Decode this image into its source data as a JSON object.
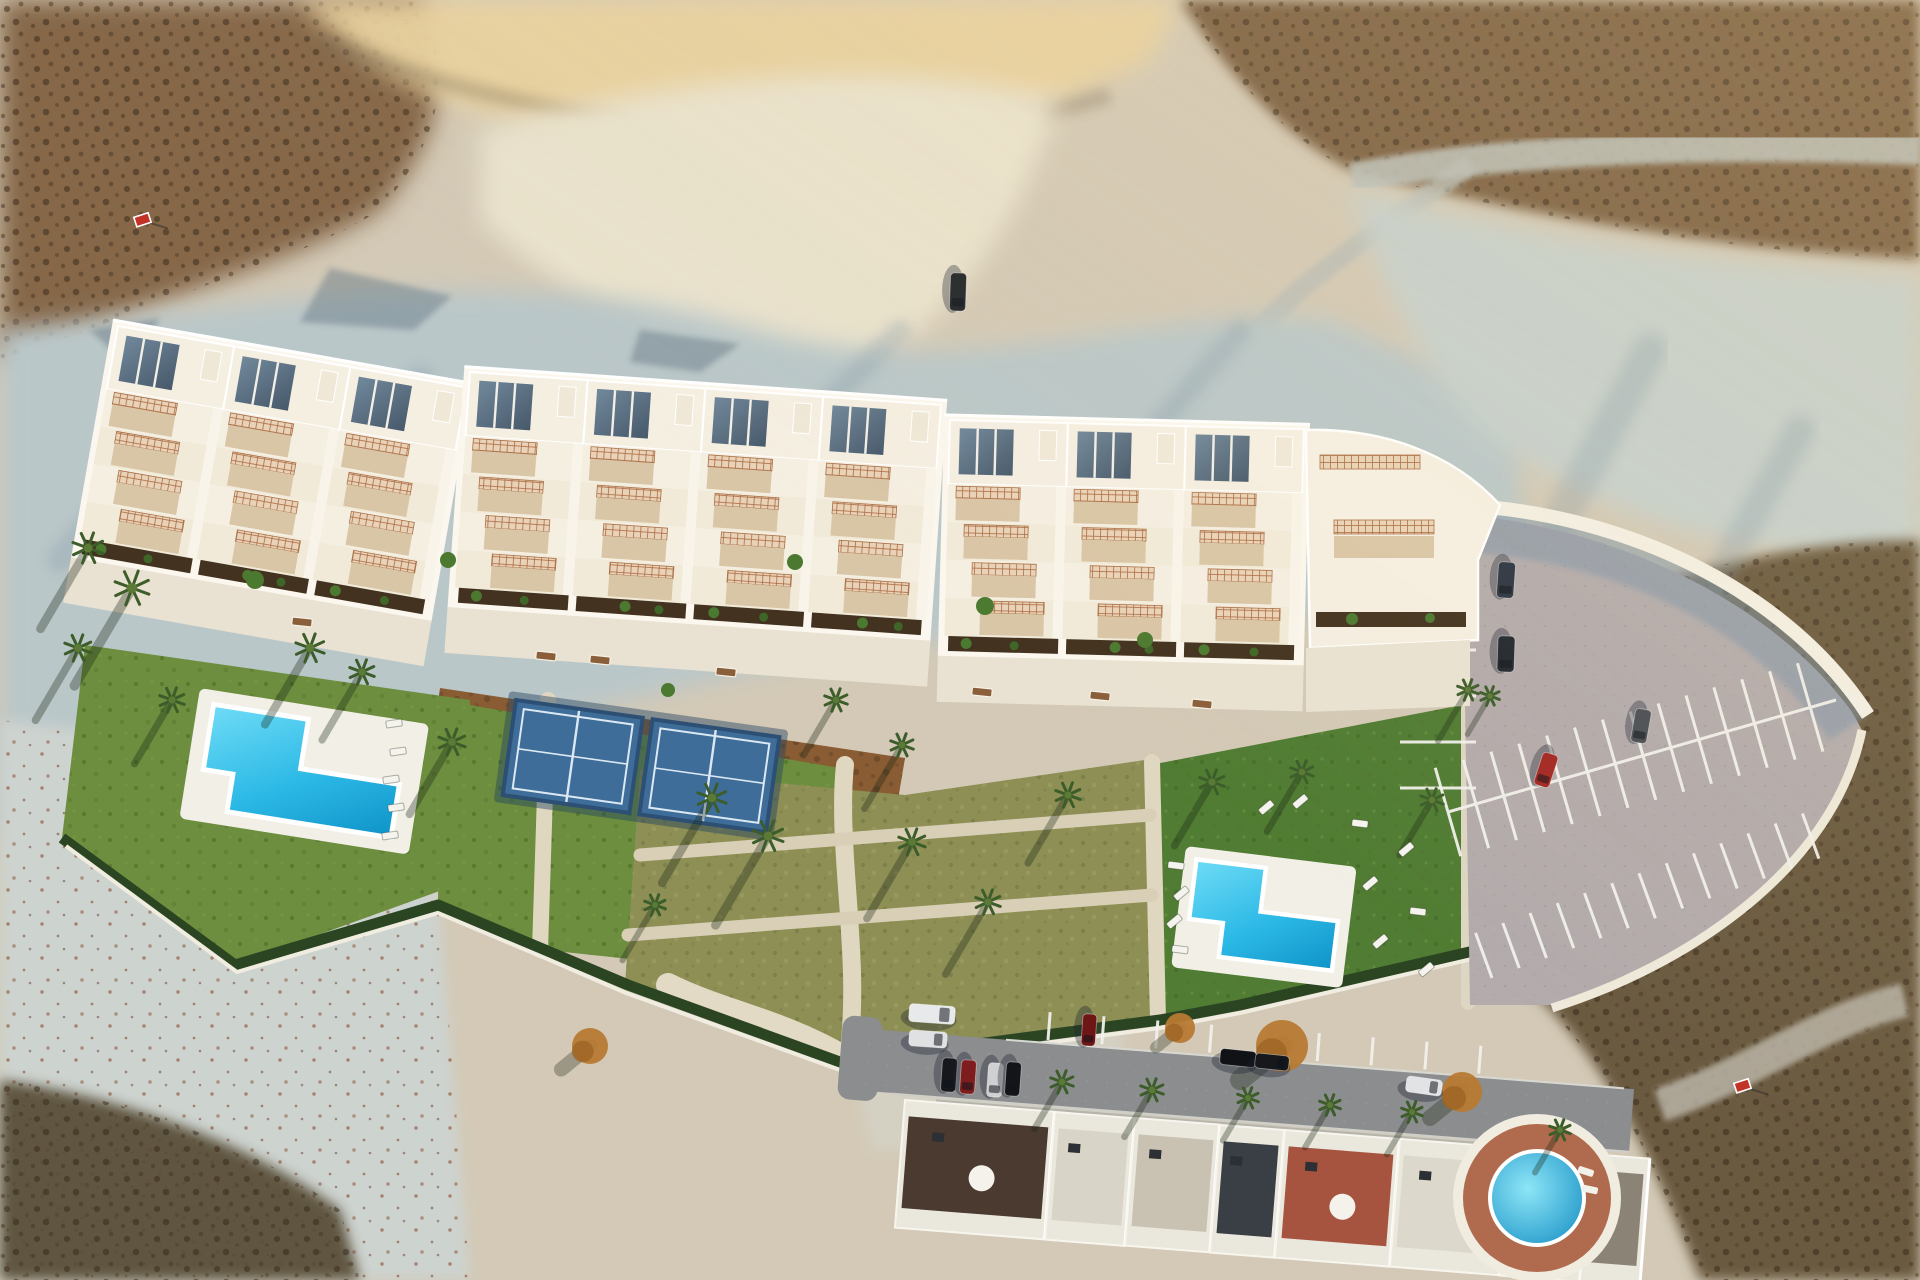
{
  "meta": {
    "description": "Aerial top-down drone render of a new hillside apartment development with gardens, pools, padel courts and parking, surrounded by arid badlands and an existing street of houses below",
    "width": 1920,
    "height": 1280
  },
  "palette": {
    "sand_base": "#d3c9b6",
    "scrub_topleft": "#86684a",
    "scrub_topright": "#7d6245",
    "scrub_bottomright": "#6a5a40",
    "gold_ridge": "#e9d2a0",
    "canyon_floor": "#e9e2cd",
    "chalk_slope": "#bac7c9",
    "chalk_right": "#c6d0cd",
    "chalk_bottomleft": "#cdd3cf",
    "dirt_lot": "#d4d0c2",
    "shadow_blue": "#7f95a4",
    "dark_wedge": "#564b36",
    "roof": "#f5efe2",
    "roof_bright": "#fbf7ee",
    "glass": "#5d7385",
    "lattice": "#b0714a",
    "lattice_bg": "#e9d3b8",
    "terrace": "#d9c6a6",
    "planter": "#42321f",
    "promenade": "#e9e2d2",
    "path": "#e0d7c0",
    "lawn": "#6c8e3e",
    "lawn_dark": "#507c33",
    "dry_garden": "#8d8f55",
    "mulch": "#8a5c33",
    "hedge": "#2b4522",
    "pool_deck": "#f1efe6",
    "pool_light": "#54d0f2",
    "pool_deep": "#129bd2",
    "court": "#3e6d99",
    "court_dark": "#2c4f73",
    "court_line": "#dce8f2",
    "parking": "#b3abac",
    "wall": "#f3efe4",
    "wall_shadow": "#7e95aa",
    "road": "#8c8d8f",
    "sidewalk": "#b6b5ab",
    "yard": "#99a187",
    "house_facade": "#eae7dc",
    "round_pool_deck": "#b06b4e",
    "sign_red": "#c33227",
    "palm": "#3c5d2a",
    "tree_orange": "#b77a33",
    "bench_wood": "#8a5f3a",
    "bush_green": "#4c7930"
  },
  "building": {
    "segments": [
      {
        "x": 118,
        "y": 326,
        "rot": 10,
        "units": 3
      },
      {
        "x": 470,
        "y": 372,
        "rot": 4,
        "units": 4
      },
      {
        "x": 950,
        "y": 420,
        "rot": 1.5,
        "units": 3
      }
    ],
    "unit_width": 118,
    "roof_height": 64,
    "terrace_rows": 4,
    "row_height": 38,
    "total_units": 10
  },
  "pools": {
    "left": {
      "x": 200,
      "y": 688,
      "rot": 9,
      "deck_w": 232,
      "deck_h": 132
    },
    "right": {
      "x": 1186,
      "y": 846,
      "rot": 7,
      "deck_w": 172,
      "deck_h": 122
    },
    "round_community": {
      "cx": 1537,
      "cy": 1198,
      "deck_r": 74,
      "water_r": 47
    }
  },
  "padel_courts": {
    "x": 516,
    "y": 700,
    "rot": 8,
    "count": 2,
    "court_w": 128,
    "court_h": 96,
    "gap": 8
  },
  "parking": {
    "rows": [
      {
        "name": "left-column",
        "x1": 1476,
        "y1": 558,
        "x2": 1476,
        "y2": 792,
        "step": 46,
        "len": 76,
        "side": 1,
        "count": 6
      },
      {
        "name": "middle-spine",
        "x1": 1448,
        "y1": 812,
        "x2": 1836,
        "y2": 700,
        "step": 29,
        "len": 46,
        "side": 2,
        "count": 14
      },
      {
        "name": "south-row",
        "x1": 1492,
        "y1": 978,
        "x2": 1848,
        "y2": 848,
        "step": 29,
        "len": 48,
        "side": -1,
        "count": 13
      },
      {
        "name": "street-bays",
        "x1": 1048,
        "y1": 1040,
        "x2": 1508,
        "y2": 1076,
        "step": 54,
        "len": 28,
        "side": -1,
        "count": 9
      }
    ]
  },
  "cars": [
    {
      "name": "truck-on-dirt-track",
      "x": 958,
      "y": 292,
      "rot": 92,
      "len": 38,
      "wid": 16,
      "color": "#23262a"
    },
    {
      "name": "suv-parking-1",
      "x": 1506,
      "y": 580,
      "rot": 94,
      "len": 36,
      "wid": 17,
      "color": "#2b3442"
    },
    {
      "name": "suv-parking-2",
      "x": 1506,
      "y": 654,
      "rot": 92,
      "len": 36,
      "wid": 17,
      "color": "#20262e"
    },
    {
      "name": "grey-car-parking",
      "x": 1641,
      "y": 726,
      "rot": 100,
      "len": 34,
      "wid": 16,
      "color": "#4a4e55"
    },
    {
      "name": "red-car-parking",
      "x": 1546,
      "y": 770,
      "rot": 108,
      "len": 34,
      "wid": 16,
      "color": "#a32723"
    },
    {
      "name": "white-van-street",
      "x": 932,
      "y": 1014,
      "rot": 4,
      "len": 46,
      "wid": 18,
      "color": "#e8e9ea"
    },
    {
      "name": "white-car-street",
      "x": 928,
      "y": 1039,
      "rot": 4,
      "len": 38,
      "wid": 16,
      "color": "#dfe1e2"
    },
    {
      "name": "black-car-row-1",
      "x": 949,
      "y": 1075,
      "rot": 94,
      "len": 34,
      "wid": 15,
      "color": "#17181b"
    },
    {
      "name": "red-car-row",
      "x": 968,
      "y": 1077,
      "rot": 94,
      "len": 34,
      "wid": 15,
      "color": "#7e1d1d"
    },
    {
      "name": "white-car-row",
      "x": 995,
      "y": 1080,
      "rot": 94,
      "len": 34,
      "wid": 15,
      "color": "#cfd0d2"
    },
    {
      "name": "black-car-row-2",
      "x": 1013,
      "y": 1079,
      "rot": 94,
      "len": 34,
      "wid": 15,
      "color": "#141518"
    },
    {
      "name": "darkred-car-bay",
      "x": 1089,
      "y": 1030,
      "rot": 94,
      "len": 32,
      "wid": 14,
      "color": "#6e1616"
    },
    {
      "name": "black-car-road-1",
      "x": 1238,
      "y": 1058,
      "rot": 6,
      "len": 36,
      "wid": 16,
      "color": "#101215"
    },
    {
      "name": "black-car-road-2",
      "x": 1272,
      "y": 1062,
      "rot": 6,
      "len": 34,
      "wid": 15,
      "color": "#16181c"
    },
    {
      "name": "white-car-road-right",
      "x": 1424,
      "y": 1086,
      "rot": 8,
      "len": 36,
      "wid": 16,
      "color": "#e2e3e4"
    }
  ],
  "vegetation": {
    "palms": [
      [
        88,
        548,
        16,
        95
      ],
      [
        132,
        588,
        18,
        115
      ],
      [
        78,
        648,
        14,
        85
      ],
      [
        172,
        700,
        13,
        75
      ],
      [
        310,
        648,
        15,
        90
      ],
      [
        362,
        672,
        13,
        80
      ],
      [
        452,
        742,
        14,
        85
      ],
      [
        836,
        700,
        12,
        65
      ],
      [
        712,
        798,
        15,
        100
      ],
      [
        768,
        836,
        16,
        105
      ],
      [
        912,
        842,
        14,
        90
      ],
      [
        988,
        902,
        13,
        85
      ],
      [
        1068,
        795,
        13,
        80
      ],
      [
        902,
        745,
        12,
        75
      ],
      [
        655,
        905,
        11,
        65
      ],
      [
        1212,
        782,
        13,
        75
      ],
      [
        1302,
        772,
        12,
        70
      ],
      [
        1432,
        800,
        12,
        65
      ],
      [
        1468,
        690,
        11,
        60
      ],
      [
        1490,
        696,
        10,
        45
      ],
      [
        1062,
        1082,
        12,
        55
      ],
      [
        1152,
        1090,
        12,
        55
      ],
      [
        1248,
        1098,
        11,
        50
      ],
      [
        1330,
        1105,
        11,
        50
      ],
      [
        1412,
        1112,
        11,
        50
      ],
      [
        1560,
        1130,
        11,
        50
      ]
    ],
    "orange_trees": [
      [
        1282,
        1046,
        26
      ],
      [
        1462,
        1092,
        20
      ],
      [
        1180,
        1028,
        15
      ],
      [
        590,
        1046,
        18
      ]
    ],
    "bushes": [
      [
        255,
        580,
        9
      ],
      [
        448,
        560,
        8
      ],
      [
        795,
        562,
        8
      ],
      [
        985,
        606,
        9
      ],
      [
        668,
        690,
        7
      ],
      [
        1145,
        640,
        8
      ]
    ]
  },
  "furniture": {
    "loungers_left": [
      [
        386,
        720
      ],
      [
        390,
        748
      ],
      [
        383,
        776
      ],
      [
        388,
        804
      ],
      [
        382,
        832
      ]
    ],
    "loungers_right": [
      [
        1168,
        862
      ],
      [
        1173,
        890
      ],
      [
        1166,
        918
      ],
      [
        1172,
        946
      ],
      [
        1258,
        804
      ],
      [
        1292,
        798
      ],
      [
        1352,
        820
      ],
      [
        1398,
        846
      ],
      [
        1362,
        880
      ],
      [
        1410,
        908
      ],
      [
        1372,
        938
      ],
      [
        1418,
        966
      ]
    ],
    "benches": [
      [
        292,
        618
      ],
      [
        536,
        652
      ],
      [
        590,
        656
      ],
      [
        716,
        668
      ],
      [
        972,
        688
      ],
      [
        1090,
        692
      ],
      [
        1192,
        700
      ]
    ]
  },
  "signs": {
    "for_sale_top": {
      "x": 142,
      "y": 220
    },
    "for_sale_bottom": {
      "x": 1742,
      "y": 1086
    }
  },
  "street": {
    "road": {
      "x": 858,
      "y": 1008,
      "rot": 4.5,
      "len": 780,
      "wid": 62
    },
    "houses": [
      {
        "x": 905,
        "y": 1100,
        "w": 150,
        "roof": "#4a3a30",
        "dome": true
      },
      {
        "x": 1055,
        "y": 1112,
        "w": 80,
        "roof": "#d8d4c8",
        "dome": false
      },
      {
        "x": 1135,
        "y": 1118,
        "w": 85,
        "roof": "#c9c2b2",
        "dome": false
      },
      {
        "x": 1220,
        "y": 1125,
        "w": 65,
        "roof": "#3a3f46",
        "dome": false
      },
      {
        "x": 1285,
        "y": 1130,
        "w": 115,
        "roof": "#a65440",
        "dome": true
      },
      {
        "x": 1400,
        "y": 1139,
        "w": 110,
        "roof": "#ddd8cc",
        "dome": false
      },
      {
        "x": 1510,
        "y": 1148,
        "w": 80,
        "roof": "#454a50",
        "dome": false
      },
      {
        "x": 1590,
        "y": 1154,
        "w": 60,
        "roof": "#8c8377",
        "dome": false
      }
    ]
  }
}
